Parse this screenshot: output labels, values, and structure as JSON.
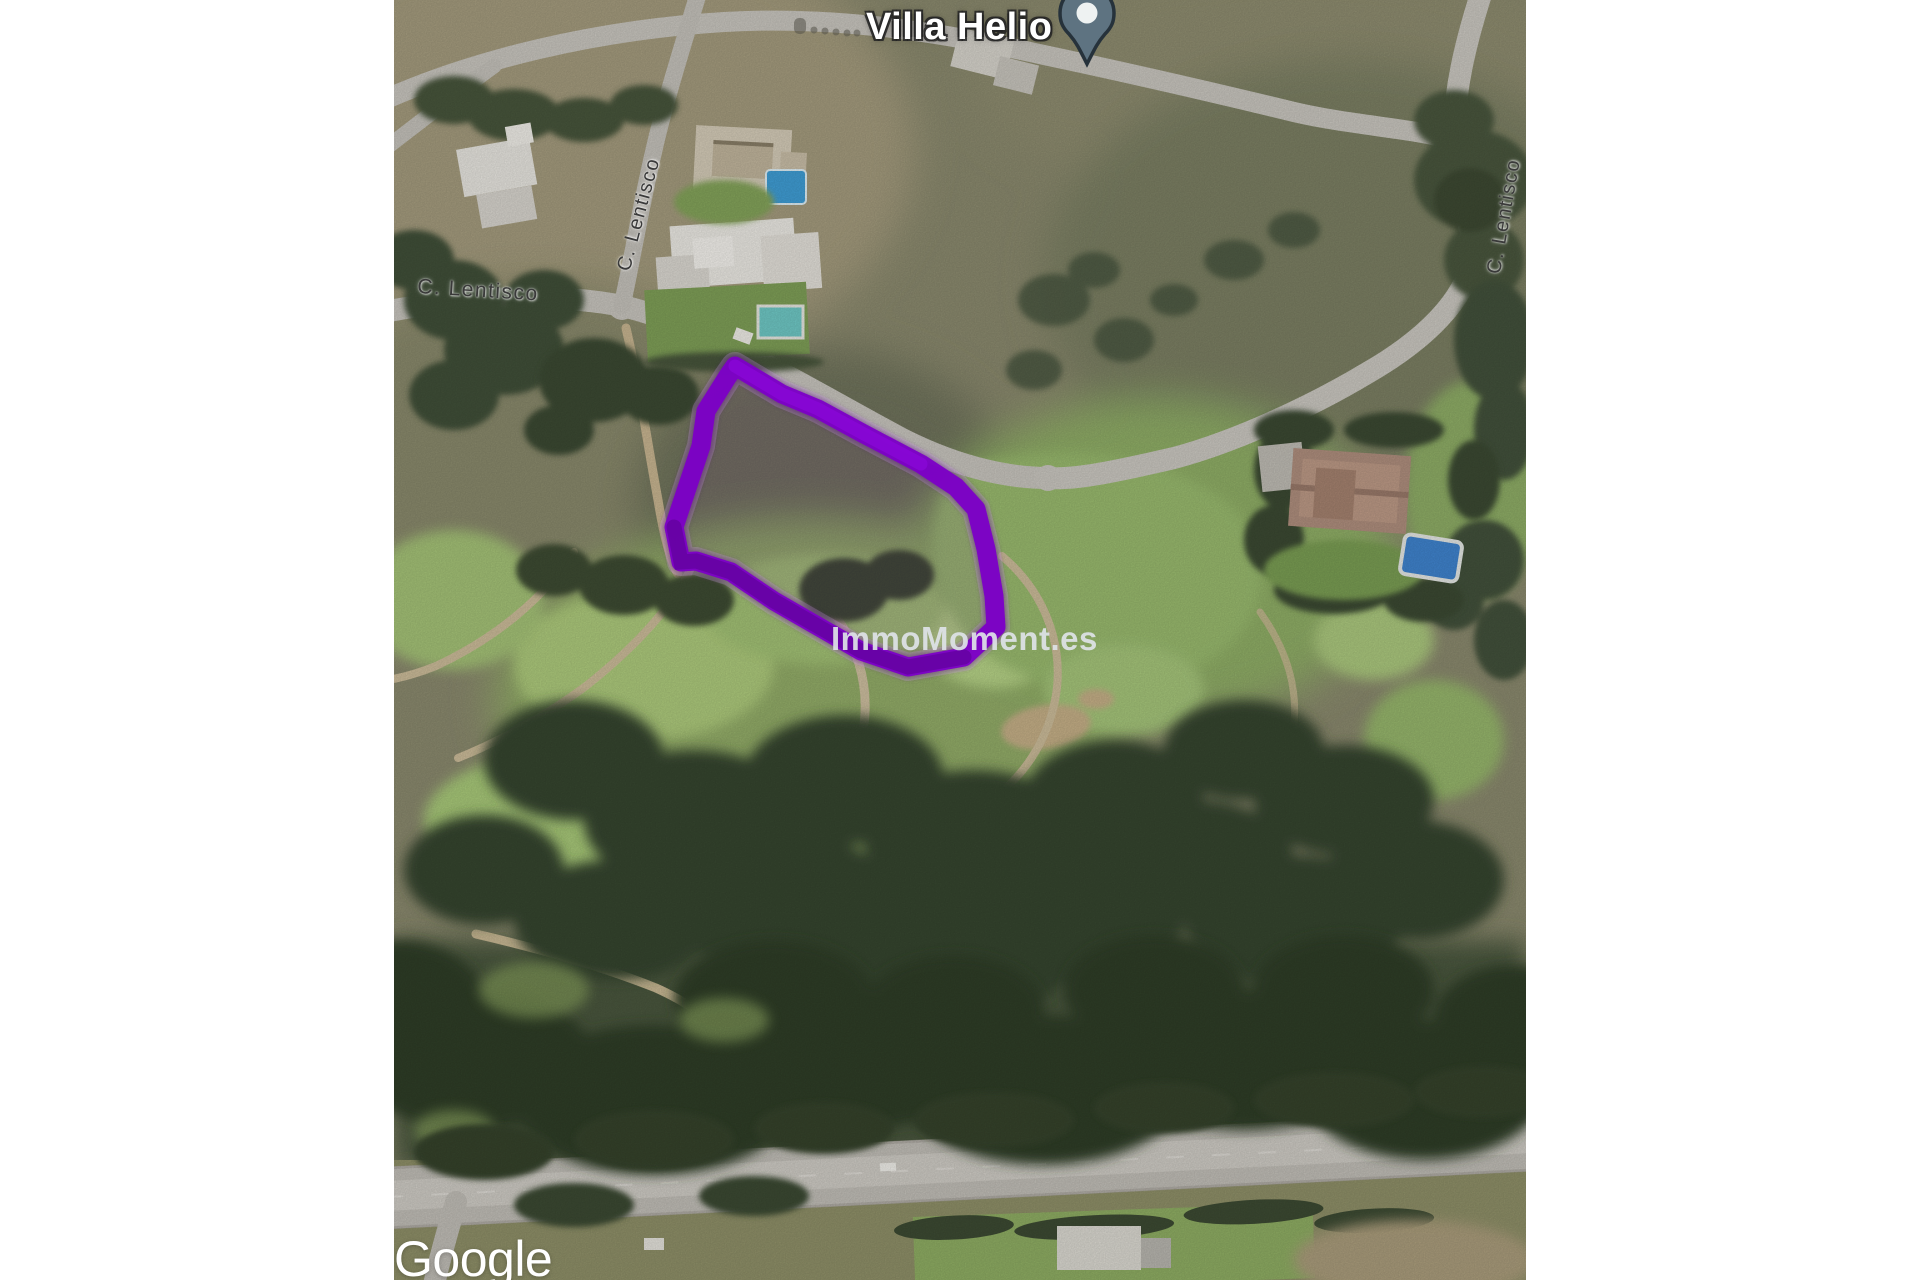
{
  "window": {
    "background": "#ffffff"
  },
  "map": {
    "place_label": "Villa Helio",
    "watermark": "ImmoMoment.es",
    "attribution": "Google",
    "streets": {
      "lentisco_horizontal": "C. Lentisco",
      "lentisco_vertical_upper": "C. Lentisco",
      "lentisco_vertical_right": "C. Lentisco"
    },
    "colors": {
      "plot_outline": "#7d00c8",
      "plot_outline_halo": "#e3bdfc",
      "plot_outline_shadow": "#46006e",
      "pin_fill": "#5e7381",
      "pin_outline": "#26323b",
      "pin_dot": "#eef2f2",
      "watermark": "#dfe3e8",
      "place_label": "#ffffff",
      "street_label": "#3a3a3a",
      "attribution": "#ffffff"
    }
  }
}
